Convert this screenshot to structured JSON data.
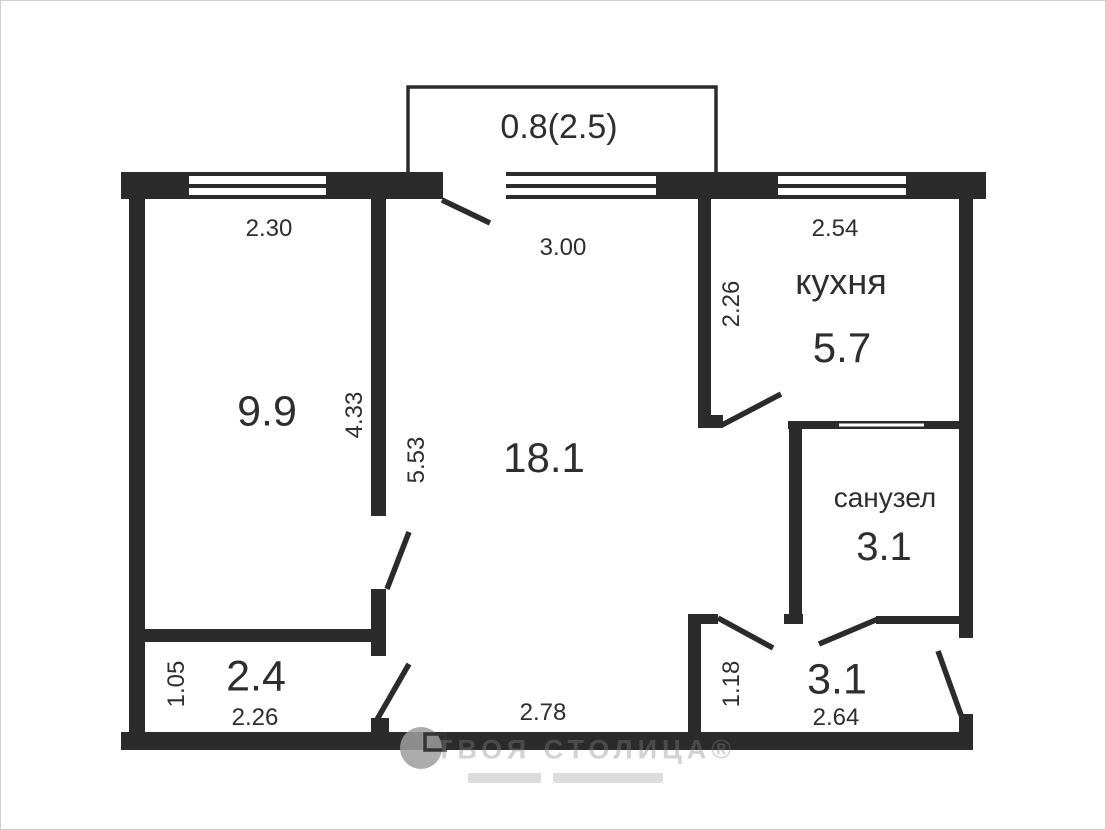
{
  "rooms": {
    "bedroom": {
      "area": "9.9"
    },
    "living": {
      "area": "18.1"
    },
    "kitchen": {
      "name": "кухня",
      "area": "5.7"
    },
    "bathroom": {
      "name": "санузел",
      "area": "3.1"
    },
    "corridor": {
      "area": "2.4"
    },
    "hallway": {
      "area": "3.1"
    },
    "balcony": {
      "area": "0.8(2.5)"
    }
  },
  "dimensions": {
    "bedroom_width": "2.30",
    "bedroom_depth": "4.33",
    "living_width": "3.00",
    "living_depth": "5.53",
    "living_bottom_width": "2.78",
    "kitchen_width": "2.54",
    "kitchen_depth": "2.26",
    "corridor_depth": "1.05",
    "corridor_width": "2.26",
    "hallway_depth": "1.18",
    "hallway_width": "2.64"
  },
  "watermark": {
    "brand_full": "ТВОЯ СТОЛИЦА®"
  },
  "colors": {
    "wall": "#2b2b2b",
    "text": "#2e2e2e",
    "background": "#ffffff",
    "frame": "#cfcfcf",
    "watermark_gray": "#848484"
  }
}
